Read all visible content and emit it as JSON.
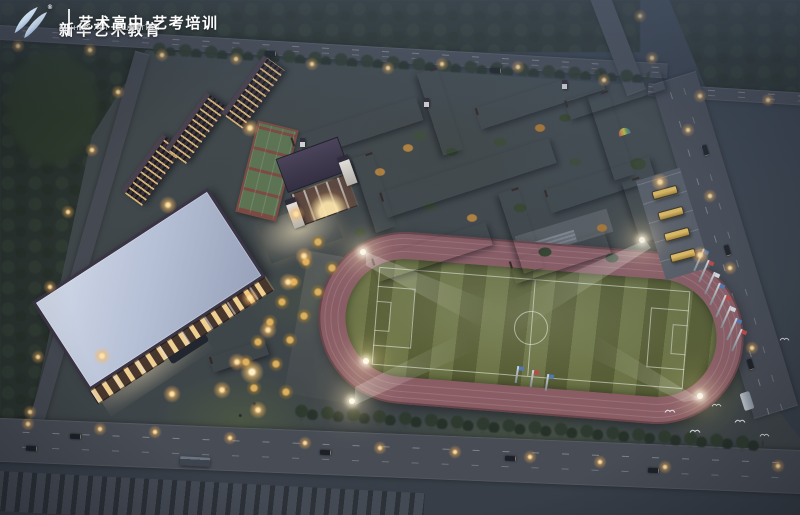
{
  "header": {
    "brand_cn": "新华艺术教育",
    "brand_en": "XINHUA ART EDUCATION",
    "registered_mark": "®",
    "tagline": "艺术高中·艺考培训",
    "logo_icon": "double-swoosh-logo"
  },
  "scene": {
    "subject": "aerial dusk rendering of an art-school campus",
    "elements": [
      "forest",
      "perimeter-roads",
      "teaching-buildings",
      "dormitory-slabs",
      "gymnasium",
      "chapel-auditorium",
      "basketball-courts",
      "running-track",
      "soccer-field",
      "floodlights",
      "flag-poles",
      "school-buses",
      "south-gate",
      "street-lamps",
      "birds"
    ],
    "colors": {
      "dusk_base": "#39414c",
      "forest": "#2a332f",
      "road": "#474c55",
      "track": "#8a5d65",
      "field_light": "#6d7547",
      "field_dark": "#585f36",
      "roof_purple": "#443c51",
      "brick": "#52403a",
      "window_warm": "#f4cd82",
      "window_cool": "#cddae6",
      "gym_roof": "#b6c0d6",
      "street_lamp": "#ffb054",
      "floodlight": "#fff8e0",
      "court_green": "#5d7452",
      "court_red": "#7c4a42",
      "lit_tree": "#e4b65e"
    }
  }
}
